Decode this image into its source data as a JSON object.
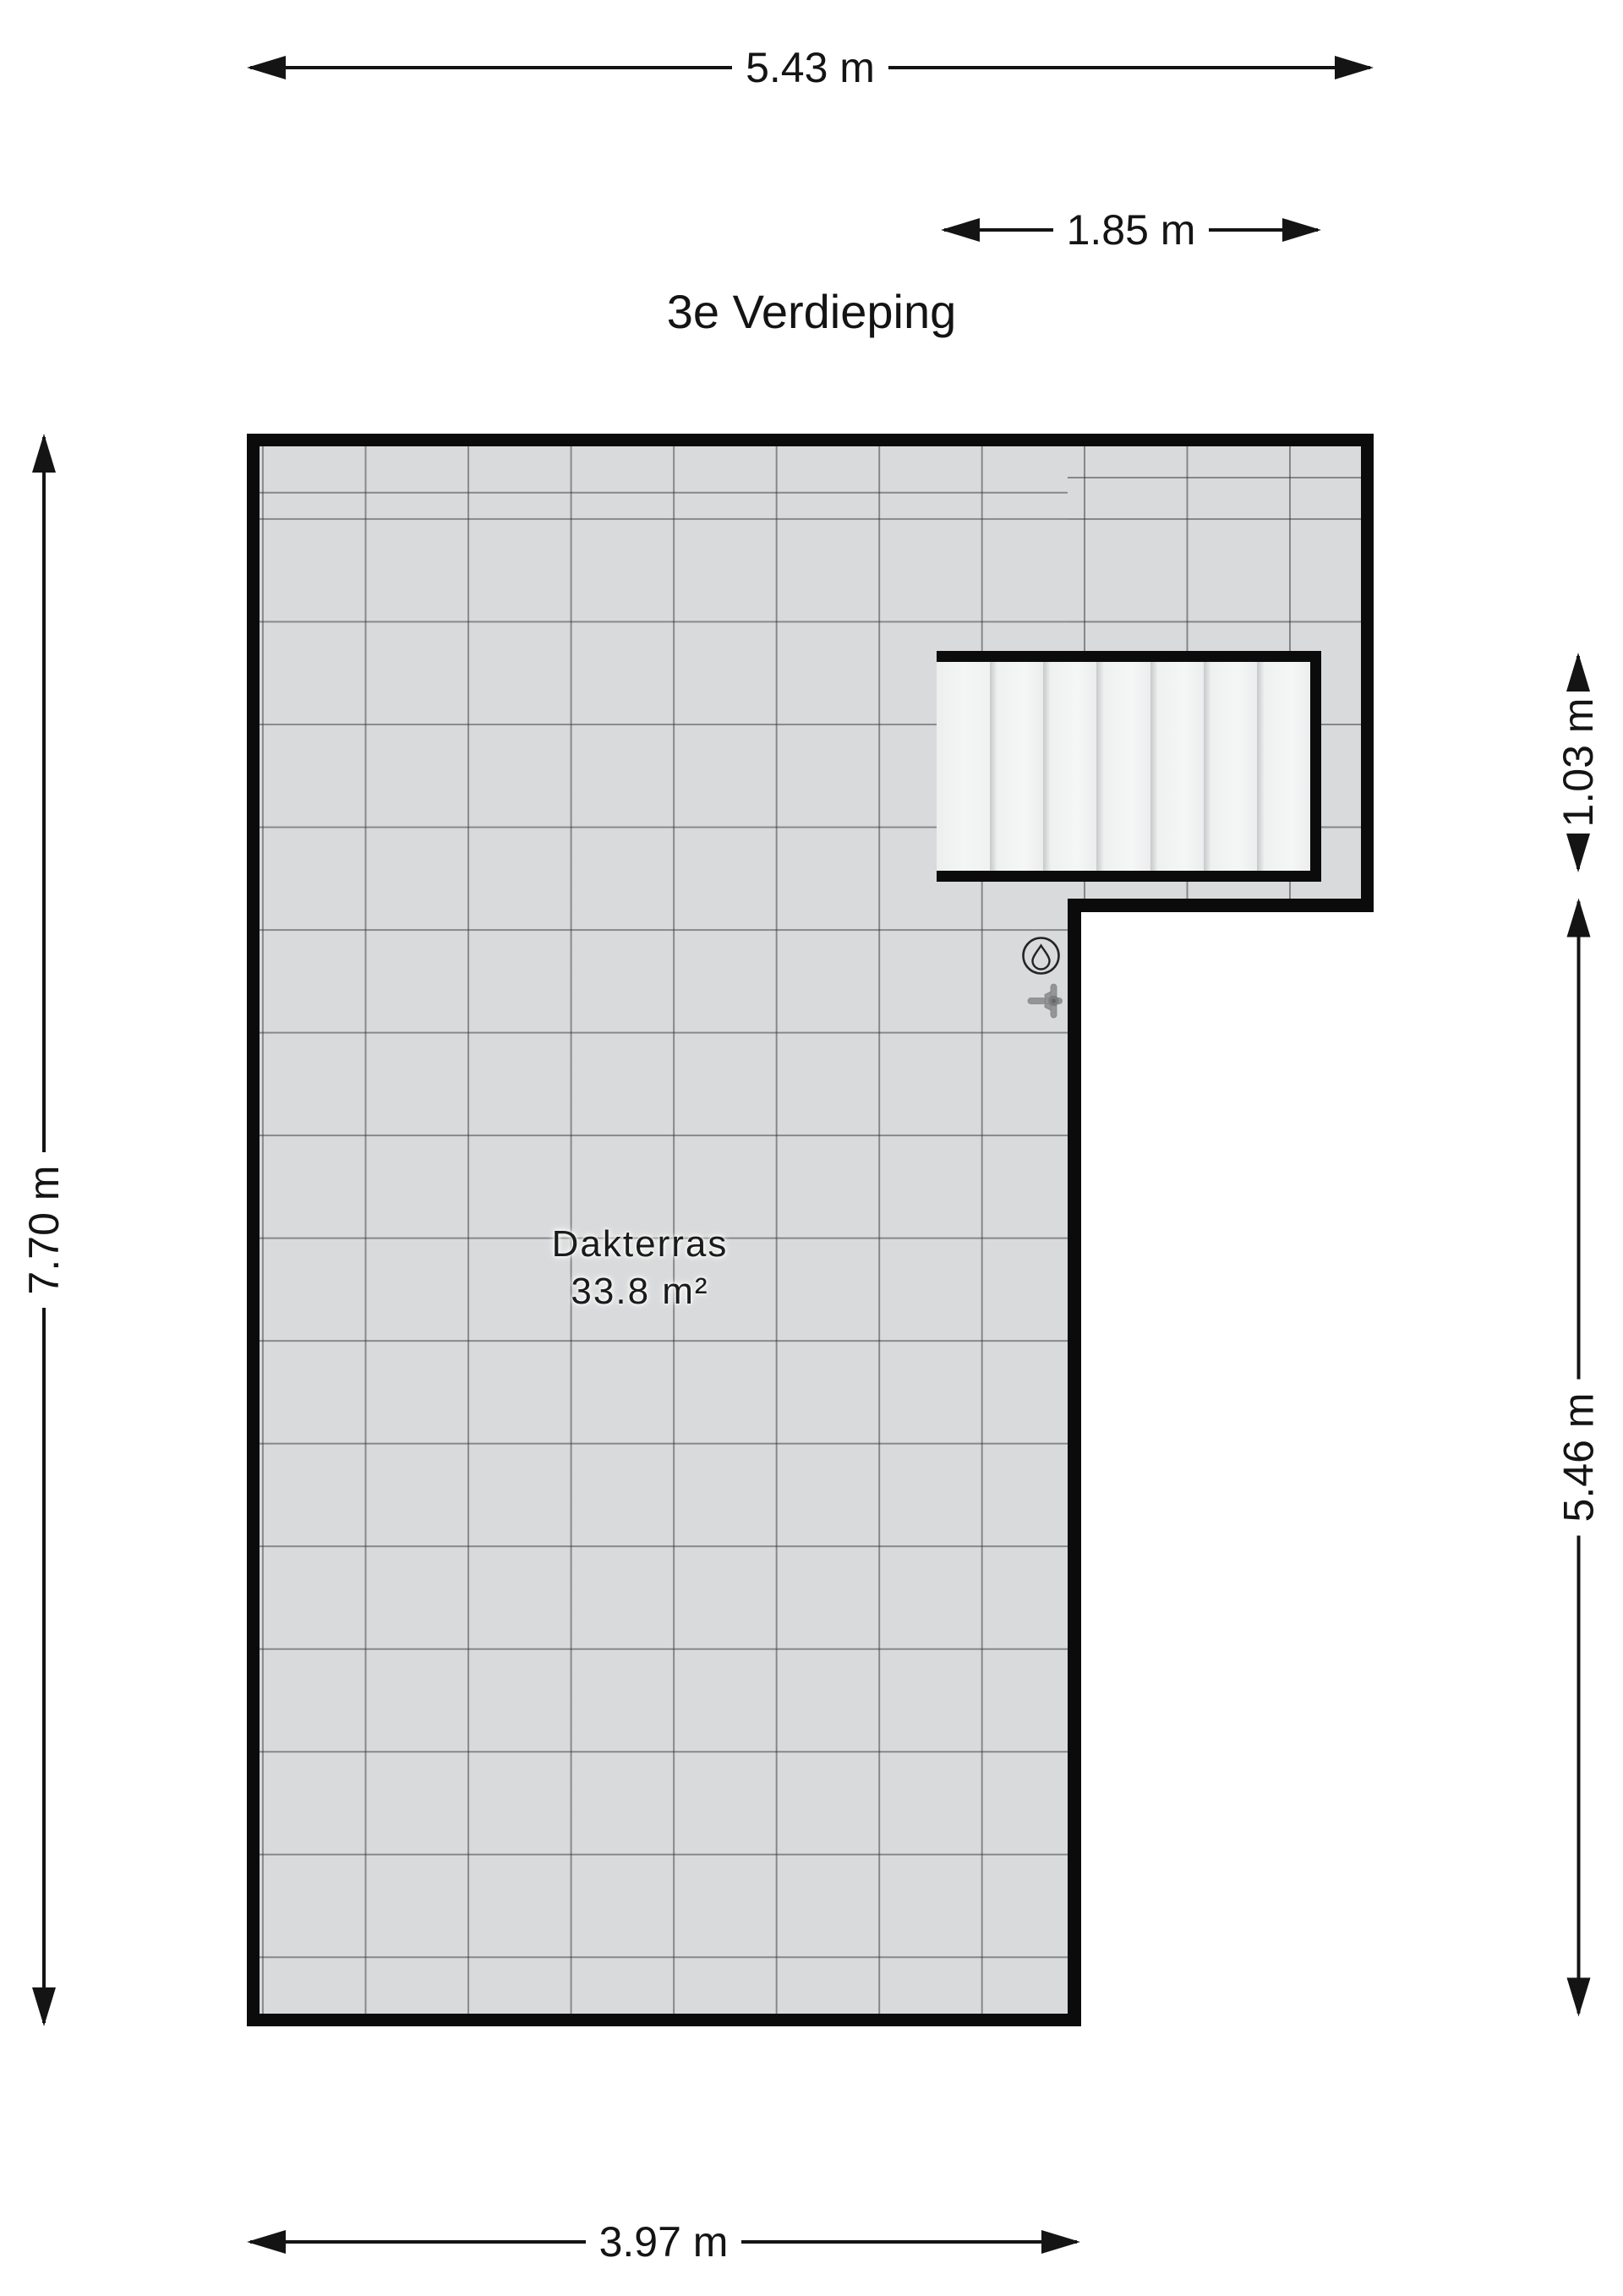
{
  "title": "3e Verdieping",
  "room": {
    "name": "Dakterras",
    "area": "33.8 m²"
  },
  "dimensions": {
    "top_width": "5.43 m",
    "stairs_width": "1.85 m",
    "left_height": "7.70 m",
    "stairs_height": "1.03 m",
    "terrace_height": "5.46 m",
    "bottom_width": "3.97 m"
  },
  "stairs": {
    "treads": 7
  },
  "icons": {
    "drain": "water-drop-in-circle",
    "faucet": "tap-top-view"
  },
  "colors": {
    "wall": "#0b0b0b",
    "tile": "#d9dadb",
    "grid_line": "#6a6a6d",
    "stair_tread": "#f2f3f3",
    "dimension_ink": "#141414",
    "background": "#ffffff"
  }
}
